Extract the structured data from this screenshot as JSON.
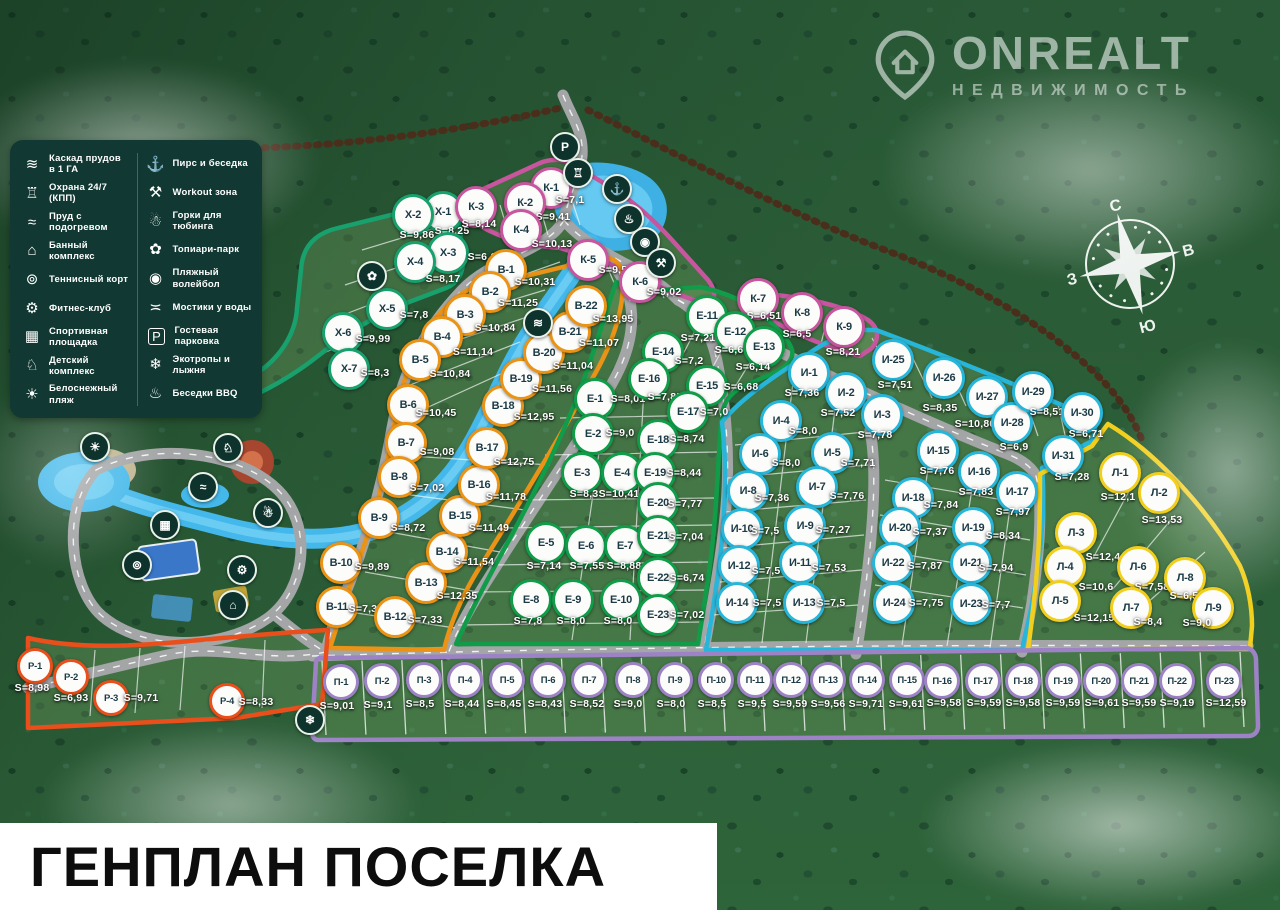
{
  "title": "ГЕНПЛАН ПОСЕЛКА",
  "logo": {
    "title": "ONREALT",
    "subtitle": "НЕДВИЖИМОСТЬ"
  },
  "compass": {
    "north": "С",
    "east": "В",
    "south": "Ю",
    "west": "З"
  },
  "area_prefix": "S=",
  "legend": {
    "columns": [
      {
        "items": [
          {
            "name": "cascade-ponds",
            "glyph": "≋",
            "label": "Каскад прудов в 1 ГА"
          },
          {
            "name": "security-24-7",
            "glyph": "♖",
            "label": "Охрана 24/7 (КПП)"
          },
          {
            "name": "heated-pond",
            "glyph": "≈",
            "label": "Пруд с подогревом"
          },
          {
            "name": "sauna-complex",
            "glyph": "⌂",
            "label": "Банный комплекс"
          },
          {
            "name": "tennis-court",
            "glyph": "⊚",
            "label": "Теннисный корт"
          },
          {
            "name": "fitness-club",
            "glyph": "⚙",
            "label": "Фитнес-клуб"
          },
          {
            "name": "sports-ground",
            "glyph": "▦",
            "label": "Спортивная площадка"
          },
          {
            "name": "kids-complex",
            "glyph": "♘",
            "label": "Детский комплекс"
          },
          {
            "name": "white-beach",
            "glyph": "☀",
            "label": "Белоснежный пляж"
          }
        ]
      },
      {
        "items": [
          {
            "name": "pier-gazebo",
            "glyph": "⚓",
            "label": "Пирс и беседка"
          },
          {
            "name": "workout-zone",
            "glyph": "⚒",
            "label": "Workout зона"
          },
          {
            "name": "tubing-hills",
            "glyph": "☃",
            "label": "Горки для тюбинга"
          },
          {
            "name": "topiary-park",
            "glyph": "✿",
            "label": "Топиари-парк"
          },
          {
            "name": "beach-volleyball",
            "glyph": "◉",
            "label": "Пляжный волейбол"
          },
          {
            "name": "water-bridges",
            "glyph": "≍",
            "label": "Мостики у воды"
          },
          {
            "name": "guest-parking",
            "glyph": "P",
            "label": "Гостевая парковка"
          },
          {
            "name": "eco-trails-ski",
            "glyph": "❄",
            "label": "Экотропы и лыжня"
          },
          {
            "name": "bbq-gazebos",
            "glyph": "♨",
            "label": "Беседки BBQ"
          }
        ]
      }
    ]
  },
  "clusters": [
    {
      "name": "Х",
      "color": "#18a06d",
      "size": 36,
      "plots": [
        [
          "Х-1",
          "8,25",
          443,
          212,
          452,
          231
        ],
        [
          "Х-2",
          "9,86",
          413,
          215,
          417,
          235
        ],
        [
          "Х-3",
          "6,1",
          448,
          253,
          482,
          257
        ],
        [
          "Х-4",
          "8,17",
          415,
          262,
          443,
          279
        ],
        [
          "Х-5",
          "7,8",
          387,
          309,
          414,
          315
        ],
        [
          "Х-6",
          "9,99",
          343,
          333,
          373,
          339
        ],
        [
          "Х-7",
          "8,3",
          349,
          369,
          375,
          373
        ]
      ]
    },
    {
      "name": "К",
      "color": "#c7569f",
      "size": 36,
      "plots": [
        [
          "К-1",
          "7,1",
          551,
          188,
          570,
          200
        ],
        [
          "К-2",
          "9,41",
          525,
          203,
          553,
          217
        ],
        [
          "К-3",
          "8,14",
          476,
          207,
          479,
          224
        ],
        [
          "К-4",
          "10,13",
          521,
          230,
          552,
          244
        ],
        [
          "К-5",
          "9,58",
          588,
          260,
          616,
          270
        ],
        [
          "К-6",
          "9,02",
          640,
          282,
          664,
          292
        ],
        [
          "К-7",
          "6,51",
          758,
          299,
          764,
          316
        ],
        [
          "К-8",
          "6,5",
          802,
          313,
          797,
          334
        ],
        [
          "К-9",
          "8,21",
          844,
          327,
          843,
          352
        ]
      ]
    },
    {
      "name": "В",
      "color": "#eb9316",
      "size": 36,
      "plots": [
        [
          "В-1",
          "10,31",
          506,
          270,
          535,
          282
        ],
        [
          "В-2",
          "11,25",
          490,
          292,
          518,
          303
        ],
        [
          "В-3",
          "10,84",
          465,
          315,
          495,
          328
        ],
        [
          "В-4",
          "11,14",
          442,
          337,
          473,
          352
        ],
        [
          "В-5",
          "10,84",
          420,
          360,
          450,
          374
        ],
        [
          "В-6",
          "10,45",
          408,
          405,
          436,
          413
        ],
        [
          "В-7",
          "9,08",
          406,
          443,
          437,
          452
        ],
        [
          "В-8",
          "7,02",
          399,
          477,
          427,
          488
        ],
        [
          "В-9",
          "8,72",
          379,
          518,
          408,
          528
        ],
        [
          "В-10",
          "9,89",
          341,
          563,
          372,
          567
        ],
        [
          "В-11",
          "7,39",
          337,
          607,
          366,
          609
        ],
        [
          "В-12",
          "7,33",
          395,
          617,
          425,
          620
        ],
        [
          "В-13",
          "12,35",
          426,
          583,
          457,
          596
        ],
        [
          "В-14",
          "11,54",
          447,
          552,
          474,
          562
        ],
        [
          "В-15",
          "11,49",
          460,
          516,
          489,
          528
        ],
        [
          "В-16",
          "11,78",
          479,
          485,
          506,
          497
        ],
        [
          "В-17",
          "12,75",
          487,
          448,
          514,
          462
        ],
        [
          "В-18",
          "12,95",
          503,
          406,
          534,
          417
        ],
        [
          "В-19",
          "11,56",
          521,
          379,
          552,
          389
        ],
        [
          "В-20",
          "11,04",
          544,
          353,
          573,
          366
        ],
        [
          "В-21",
          "11,07",
          570,
          332,
          599,
          343
        ],
        [
          "В-22",
          "13,95",
          586,
          306,
          613,
          319
        ]
      ]
    },
    {
      "name": "Е",
      "color": "#119c49",
      "size": 36,
      "plots": [
        [
          "Е-1",
          "8,01",
          595,
          399,
          628,
          399
        ],
        [
          "Е-2",
          "9,0",
          593,
          434,
          620,
          433
        ],
        [
          "Е-3",
          "8,3",
          582,
          473,
          584,
          494
        ],
        [
          "Е-4",
          "10,41",
          622,
          473,
          619,
          494
        ],
        [
          "Е-5",
          "7,14",
          546,
          543,
          544,
          566
        ],
        [
          "Е-6",
          "7,55",
          586,
          546,
          587,
          566
        ],
        [
          "Е-7",
          "8,88",
          625,
          546,
          624,
          566
        ],
        [
          "Е-8",
          "7,8",
          531,
          600,
          528,
          621
        ],
        [
          "Е-9",
          "8,0",
          573,
          600,
          571,
          621
        ],
        [
          "Е-10",
          "8,0",
          621,
          600,
          618,
          621
        ],
        [
          "Е-11",
          "7,21",
          707,
          316,
          698,
          338
        ],
        [
          "Е-12",
          "6,6",
          735,
          332,
          729,
          350
        ],
        [
          "Е-13",
          "6,14",
          764,
          347,
          753,
          367
        ],
        [
          "Е-14",
          "7,2",
          663,
          352,
          689,
          361
        ],
        [
          "Е-15",
          "6,68",
          707,
          386,
          741,
          387
        ],
        [
          "Е-16",
          "7,85",
          649,
          379,
          665,
          397
        ],
        [
          "Е-17",
          "7,0",
          688,
          412,
          714,
          412
        ],
        [
          "Е-18",
          "8,74",
          658,
          440,
          687,
          439
        ],
        [
          "Е-19",
          "8,44",
          655,
          473,
          684,
          473
        ],
        [
          "Е-20",
          "7,77",
          658,
          503,
          685,
          504
        ],
        [
          "Е-21",
          "7,04",
          658,
          536,
          686,
          537
        ],
        [
          "Е-22",
          "6,74",
          658,
          578,
          687,
          578
        ],
        [
          "Е-23",
          "7,02",
          658,
          615,
          687,
          615
        ]
      ]
    },
    {
      "name": "И",
      "color": "#27b6d9",
      "size": 36,
      "plots": [
        [
          "И-1",
          "7,36",
          809,
          373,
          802,
          393
        ],
        [
          "И-2",
          "7,52",
          846,
          393,
          838,
          413
        ],
        [
          "И-3",
          "7,78",
          882,
          415,
          875,
          435
        ],
        [
          "И-4",
          "8,0",
          781,
          421,
          803,
          431
        ],
        [
          "И-5",
          "7,71",
          832,
          453,
          858,
          463
        ],
        [
          "И-6",
          "8,0",
          760,
          454,
          786,
          463
        ],
        [
          "И-7",
          "7,76",
          817,
          487,
          847,
          496
        ],
        [
          "И-8",
          "7,36",
          748,
          491,
          772,
          498
        ],
        [
          "И-9",
          "7,27",
          805,
          526,
          833,
          530
        ],
        [
          "И-10",
          "7,5",
          742,
          529,
          765,
          531
        ],
        [
          "И-11",
          "7,53",
          800,
          563,
          829,
          568
        ],
        [
          "И-12",
          "7,5",
          739,
          566,
          766,
          571
        ],
        [
          "И-13",
          "7,5",
          804,
          603,
          831,
          603
        ],
        [
          "И-14",
          "7,5",
          737,
          603,
          767,
          603
        ],
        [
          "И-15",
          "7,76",
          938,
          451,
          937,
          471
        ],
        [
          "И-16",
          "7,83",
          979,
          472,
          976,
          492
        ],
        [
          "И-17",
          "7,97",
          1017,
          492,
          1013,
          512
        ],
        [
          "И-18",
          "7,84",
          913,
          498,
          941,
          505
        ],
        [
          "И-19",
          "8,34",
          973,
          528,
          1003,
          536
        ],
        [
          "И-20",
          "7,37",
          900,
          528,
          930,
          532
        ],
        [
          "И-21",
          "7,94",
          971,
          563,
          996,
          568
        ],
        [
          "И-22",
          "7,87",
          893,
          563,
          925,
          566
        ],
        [
          "И-23",
          "7,7",
          971,
          604,
          996,
          605
        ],
        [
          "И-24",
          "7,75",
          894,
          603,
          926,
          603
        ],
        [
          "И-25",
          "7,51",
          893,
          360,
          895,
          385
        ],
        [
          "И-26",
          "8,35",
          944,
          378,
          940,
          408
        ],
        [
          "И-27",
          "10,86",
          987,
          397,
          975,
          424
        ],
        [
          "И-28",
          "6,9",
          1012,
          423,
          1014,
          447
        ],
        [
          "И-29",
          "8,51",
          1033,
          392,
          1047,
          412
        ],
        [
          "И-30",
          "6,71",
          1082,
          413,
          1086,
          434
        ],
        [
          "И-31",
          "7,28",
          1063,
          456,
          1072,
          477
        ]
      ]
    },
    {
      "name": "Л",
      "color": "#f2cf1d",
      "size": 36,
      "plots": [
        [
          "Л-1",
          "12,1",
          1120,
          473,
          1118,
          497
        ],
        [
          "Л-2",
          "13,53",
          1159,
          493,
          1162,
          520
        ],
        [
          "Л-3",
          "12,44",
          1076,
          533,
          1106,
          557
        ],
        [
          "Л-4",
          "10,6",
          1065,
          567,
          1096,
          587
        ],
        [
          "Л-5",
          "12,15",
          1060,
          601,
          1094,
          618
        ],
        [
          "Л-6",
          "7,58",
          1138,
          567,
          1152,
          587
        ],
        [
          "Л-7",
          "8,4",
          1131,
          608,
          1148,
          622
        ],
        [
          "Л-8",
          "6,53",
          1185,
          578,
          1187,
          596
        ],
        [
          "Л-9",
          "9,0",
          1213,
          608,
          1197,
          623
        ]
      ]
    },
    {
      "name": "П",
      "color": "#9d83c6",
      "size": 30,
      "plots": [
        [
          "П-1",
          "9,01",
          341,
          682,
          337,
          706
        ],
        [
          "П-2",
          "9,1",
          382,
          681,
          378,
          705
        ],
        [
          "П-3",
          "8,5",
          424,
          680,
          420,
          704
        ],
        [
          "П-4",
          "8,44",
          465,
          680,
          462,
          704
        ],
        [
          "П-5",
          "8,45",
          507,
          680,
          504,
          704
        ],
        [
          "П-6",
          "8,43",
          548,
          680,
          545,
          704
        ],
        [
          "П-7",
          "8,52",
          589,
          680,
          587,
          704
        ],
        [
          "П-8",
          "9,0",
          633,
          680,
          628,
          704
        ],
        [
          "П-9",
          "8,0",
          675,
          680,
          671,
          704
        ],
        [
          "П-10",
          "8,5",
          716,
          680,
          712,
          704
        ],
        [
          "П-11",
          "9,5",
          755,
          680,
          752,
          704
        ],
        [
          "П-12",
          "9,59",
          791,
          680,
          790,
          704
        ],
        [
          "П-13",
          "9,56",
          828,
          680,
          828,
          704
        ],
        [
          "П-14",
          "9,71",
          867,
          680,
          866,
          704
        ],
        [
          "П-15",
          "9,61",
          907,
          680,
          906,
          704
        ],
        [
          "П-16",
          "9,58",
          942,
          681,
          944,
          703
        ],
        [
          "П-17",
          "9,59",
          983,
          681,
          984,
          703
        ],
        [
          "П-18",
          "9,58",
          1023,
          681,
          1023,
          703
        ],
        [
          "П-19",
          "9,59",
          1063,
          681,
          1063,
          703
        ],
        [
          "П-20",
          "9,61",
          1101,
          681,
          1102,
          703
        ],
        [
          "П-21",
          "9,59",
          1139,
          681,
          1139,
          703
        ],
        [
          "П-22",
          "9,19",
          1177,
          681,
          1177,
          703
        ],
        [
          "П-23",
          "12,59",
          1224,
          681,
          1226,
          703
        ]
      ]
    },
    {
      "name": "Р",
      "color": "#e94e1b",
      "size": 30,
      "plots": [
        [
          "Р-1",
          "8,98",
          35,
          666,
          32,
          688
        ],
        [
          "Р-2",
          "6,93",
          71,
          677,
          71,
          698
        ],
        [
          "Р-3",
          "9,71",
          111,
          698,
          141,
          698
        ],
        [
          "Р-4",
          "8,33",
          227,
          701,
          256,
          702
        ]
      ]
    }
  ],
  "amenities": [
    {
      "name": "guest-parking-marker",
      "glyph": "P",
      "x": 565,
      "y": 147
    },
    {
      "name": "security-marker",
      "glyph": "♖",
      "x": 578,
      "y": 173
    },
    {
      "name": "pier-marker",
      "glyph": "⚓",
      "x": 617,
      "y": 189
    },
    {
      "name": "bbq-marker",
      "glyph": "♨",
      "x": 629,
      "y": 219
    },
    {
      "name": "volleyball-marker",
      "glyph": "◉",
      "x": 645,
      "y": 242
    },
    {
      "name": "workout-marker",
      "glyph": "⚒",
      "x": 661,
      "y": 263
    },
    {
      "name": "topiary-marker",
      "glyph": "✿",
      "x": 372,
      "y": 276
    },
    {
      "name": "cascade-marker",
      "glyph": "≋",
      "x": 538,
      "y": 323
    },
    {
      "name": "beach-marker",
      "glyph": "☀",
      "x": 95,
      "y": 447
    },
    {
      "name": "kids-complex-marker",
      "glyph": "♘",
      "x": 228,
      "y": 448
    },
    {
      "name": "heated-pond-marker",
      "glyph": "≈",
      "x": 203,
      "y": 487
    },
    {
      "name": "sports-ground-marker",
      "glyph": "▦",
      "x": 165,
      "y": 525
    },
    {
      "name": "tennis-marker",
      "glyph": "⊚",
      "x": 137,
      "y": 565
    },
    {
      "name": "tubing-marker",
      "glyph": "☃",
      "x": 268,
      "y": 513
    },
    {
      "name": "fitness-marker",
      "glyph": "⚙",
      "x": 242,
      "y": 570
    },
    {
      "name": "sauna-marker",
      "glyph": "⌂",
      "x": 233,
      "y": 605
    },
    {
      "name": "ski-trail-marker",
      "glyph": "❄",
      "x": 310,
      "y": 720
    }
  ]
}
